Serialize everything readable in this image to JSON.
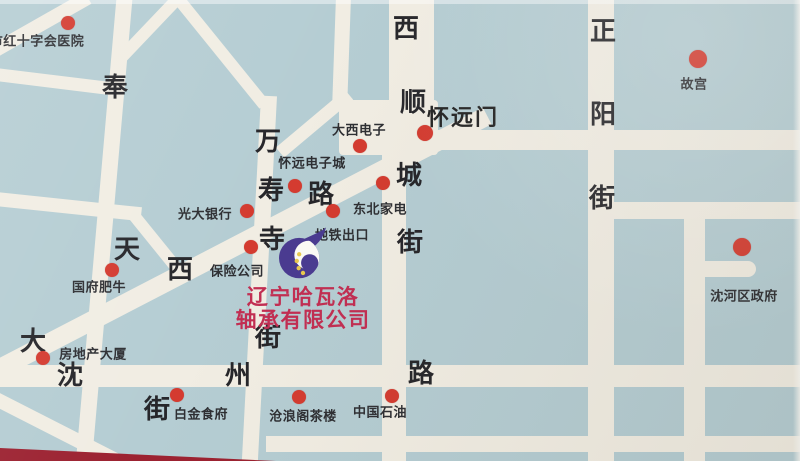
{
  "company": {
    "line1": "辽宁哈瓦洛",
    "line2": "轴承有限公司"
  },
  "landmarks": [
    {
      "label": "市红十字会医院",
      "dot": {
        "x": 68,
        "y": 23,
        "r": 7
      },
      "label_pos": {
        "x": 37,
        "y": 40
      }
    },
    {
      "label": "大西电子",
      "dot": {
        "x": 360,
        "y": 146,
        "r": 7
      },
      "label_pos": {
        "x": 359,
        "y": 129
      }
    },
    {
      "label": "怀远门",
      "dot": {
        "x": 425,
        "y": 133,
        "r": 8
      },
      "label_pos": {
        "x": 463,
        "y": 116
      },
      "style": "gate"
    },
    {
      "label": "故宫",
      "dot": {
        "x": 698,
        "y": 59,
        "r": 9
      },
      "label_pos": {
        "x": 694,
        "y": 83
      }
    },
    {
      "label": "怀远电子城",
      "dot": {
        "x": 295,
        "y": 186,
        "r": 7
      },
      "label_pos": {
        "x": 312,
        "y": 162
      }
    },
    {
      "label": "东北家电",
      "dot": {
        "x": 383,
        "y": 183,
        "r": 7
      },
      "label_pos": {
        "x": 380,
        "y": 208
      }
    },
    {
      "label": "光大银行",
      "dot": {
        "x": 247,
        "y": 211,
        "r": 7
      },
      "label_pos": {
        "x": 205,
        "y": 213
      }
    },
    {
      "label": "地铁出口",
      "dot": {
        "x": 333,
        "y": 211,
        "r": 7
      },
      "label_pos": {
        "x": 342,
        "y": 234
      }
    },
    {
      "label": "保险公司",
      "dot": {
        "x": 251,
        "y": 247,
        "r": 7
      },
      "label_pos": {
        "x": 237,
        "y": 270
      }
    },
    {
      "label": "国府肥牛",
      "dot": {
        "x": 112,
        "y": 270,
        "r": 7
      },
      "label_pos": {
        "x": 99,
        "y": 286
      }
    },
    {
      "label": "沈河区政府",
      "dot": {
        "x": 742,
        "y": 247,
        "r": 9
      },
      "label_pos": {
        "x": 744,
        "y": 295
      }
    },
    {
      "label": "房地产大厦",
      "dot": {
        "x": 43,
        "y": 358,
        "r": 7
      },
      "label_pos": {
        "x": 93,
        "y": 353
      }
    },
    {
      "label": "白金食府",
      "dot": {
        "x": 177,
        "y": 395,
        "r": 7
      },
      "label_pos": {
        "x": 201,
        "y": 413
      }
    },
    {
      "label": "沧浪阁茶楼",
      "dot": {
        "x": 299,
        "y": 397,
        "r": 7
      },
      "label_pos": {
        "x": 303,
        "y": 415
      }
    },
    {
      "label": "中国石油",
      "dot": {
        "x": 392,
        "y": 396,
        "r": 7
      },
      "label_pos": {
        "x": 380,
        "y": 411
      }
    }
  ],
  "street_names": [
    {
      "name": "奉天街",
      "chars": [
        {
          "ch": "奉",
          "x": 115,
          "y": 88
        },
        {
          "ch": "天",
          "x": 127,
          "y": 250
        },
        {
          "ch": "街",
          "x": 157,
          "y": 410
        }
      ]
    },
    {
      "name": "万寿寺街",
      "chars": [
        {
          "ch": "万",
          "x": 268,
          "y": 142
        },
        {
          "ch": "寿",
          "x": 271,
          "y": 191
        },
        {
          "ch": "寺",
          "x": 272,
          "y": 240
        },
        {
          "ch": "街",
          "x": 268,
          "y": 338
        }
      ]
    },
    {
      "name": "大西路",
      "chars": [
        {
          "ch": "大",
          "x": 33,
          "y": 342
        },
        {
          "ch": "西",
          "x": 180,
          "y": 270
        },
        {
          "ch": "路",
          "x": 321,
          "y": 195
        }
      ]
    },
    {
      "name": "西顺城街",
      "chars": [
        {
          "ch": "西",
          "x": 406,
          "y": 29
        },
        {
          "ch": "顺",
          "x": 413,
          "y": 103
        },
        {
          "ch": "城",
          "x": 409,
          "y": 176
        },
        {
          "ch": "街",
          "x": 410,
          "y": 243
        }
      ]
    },
    {
      "name": "正阳街",
      "chars": [
        {
          "ch": "正",
          "x": 603,
          "y": 32
        },
        {
          "ch": "阳",
          "x": 603,
          "y": 115
        },
        {
          "ch": "街",
          "x": 602,
          "y": 199
        }
      ]
    },
    {
      "name": "沈州路",
      "chars": [
        {
          "ch": "沈",
          "x": 70,
          "y": 376
        },
        {
          "ch": "州",
          "x": 238,
          "y": 376
        },
        {
          "ch": "路",
          "x": 421,
          "y": 374
        }
      ]
    }
  ],
  "colors": {
    "background": "#b5cdd3",
    "road": "#f1ede3",
    "dot": "#d43b30",
    "street_text": "#26262a",
    "label_text": "#2e2f33",
    "company_text": "#c22e52",
    "logo_purple": "#4a3b91",
    "logo_yellow": "#e9c94e",
    "card_edge_red": "#a82333"
  }
}
